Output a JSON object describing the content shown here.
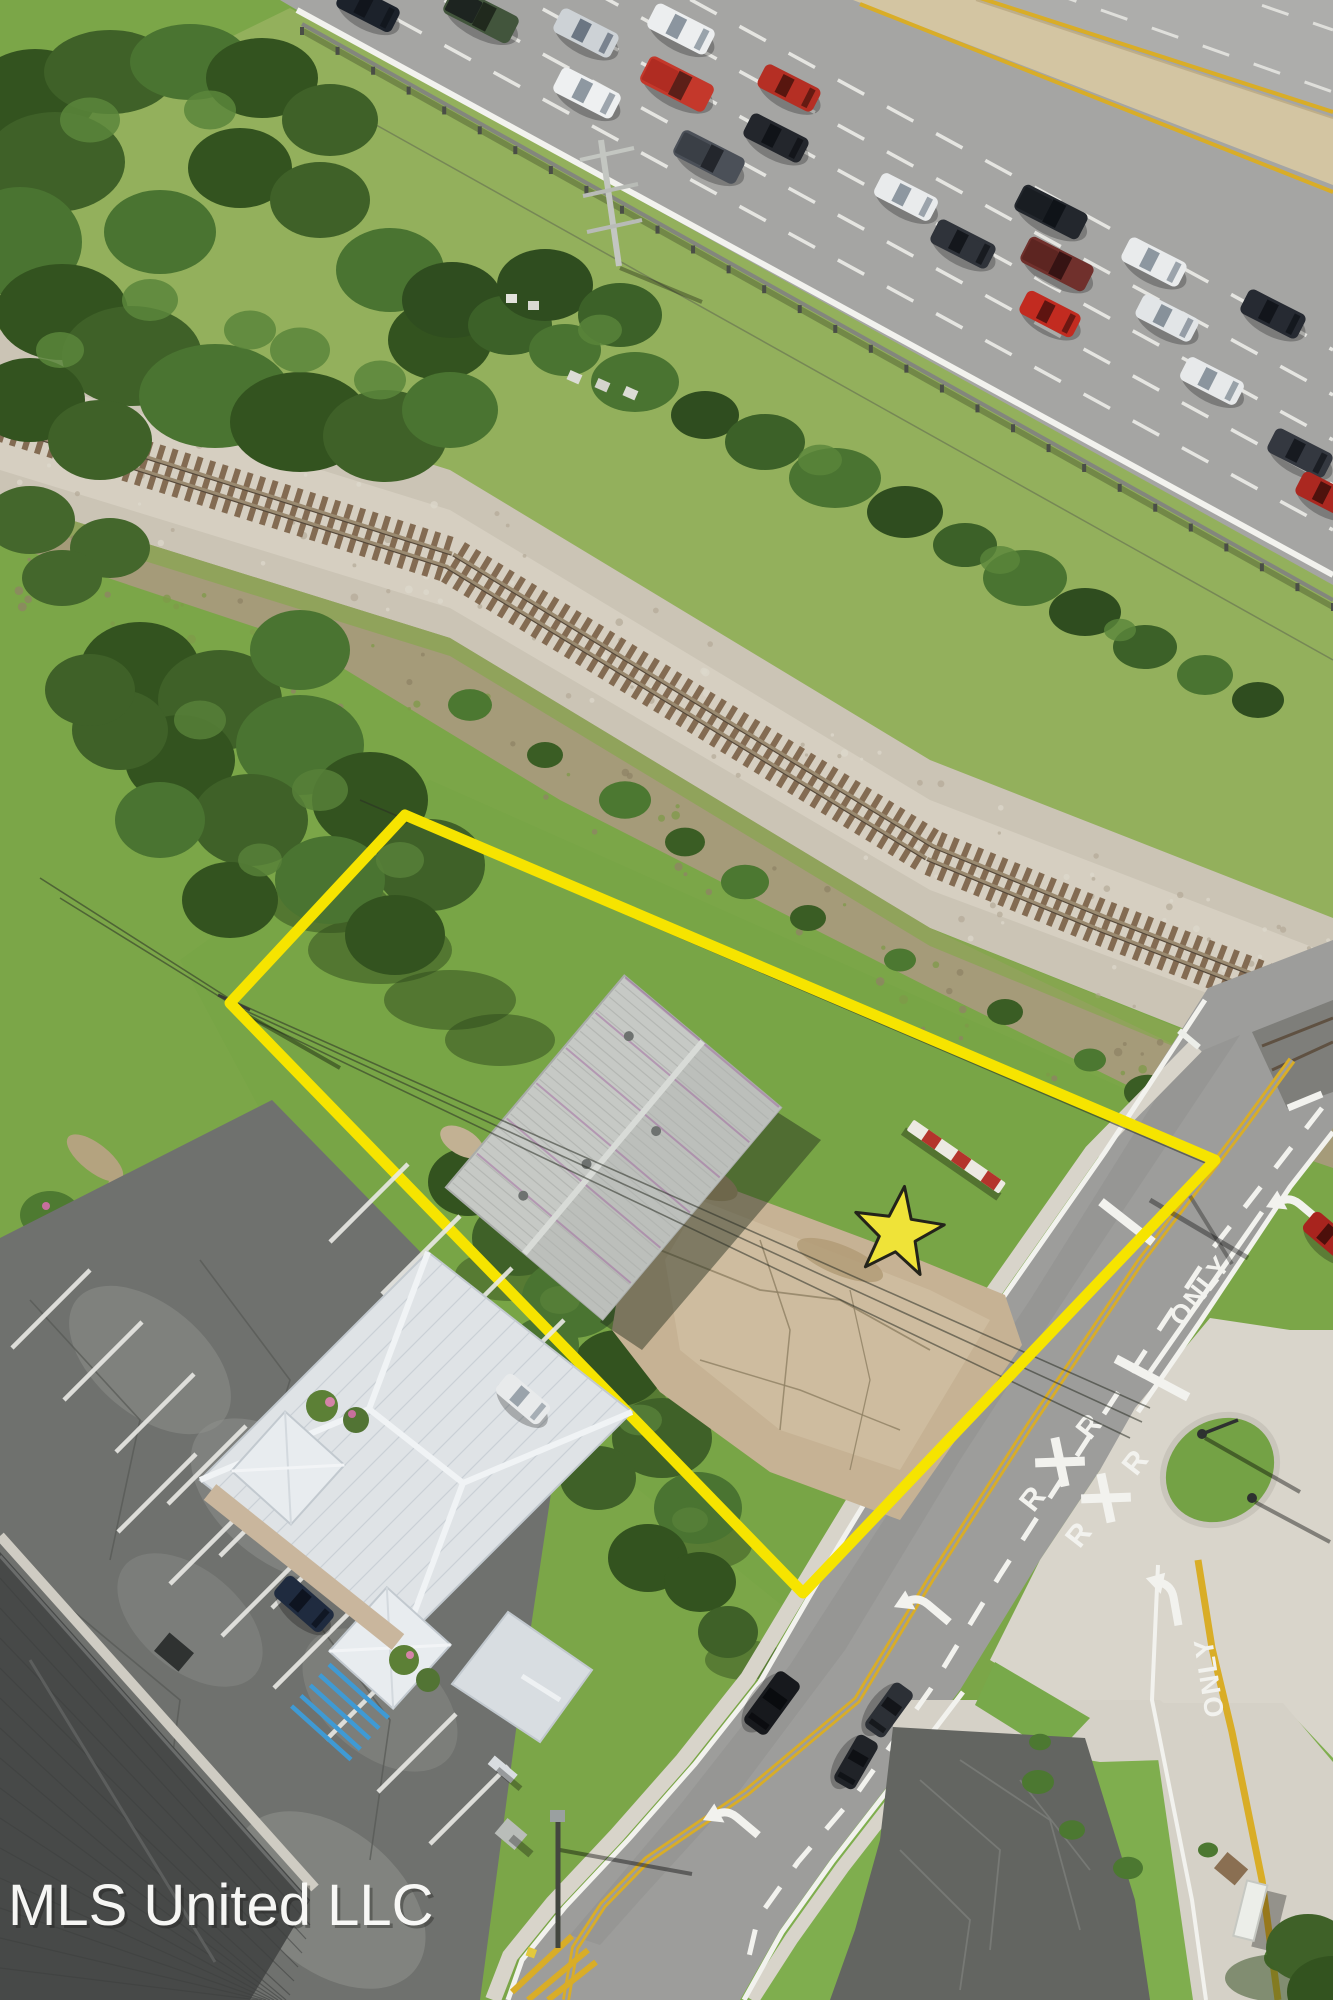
{
  "watermark": {
    "text": "MLS United LLC"
  },
  "property": {
    "boundary_points": "405,815 1215,1160 803,1593 230,1003",
    "boundary_color": "#f6e400",
    "star": {
      "cx": 898,
      "cy": 1233,
      "outer_r": 47,
      "inner_r": 19,
      "rotation": 8,
      "fill": "#efe338",
      "stroke": "#23231a"
    }
  },
  "road_markings": {
    "only_label": "ONLY",
    "rxr_letter": "R",
    "only_instances": [
      {
        "x": 1207,
        "y": 1296,
        "rot": -52
      },
      {
        "x": 1218,
        "y": 1676,
        "rot": -99
      }
    ],
    "rxr_instances": [
      {
        "x": 1060,
        "y": 1462,
        "rot": -52
      },
      {
        "x": 1106,
        "y": 1498,
        "rot": -52
      }
    ],
    "turn_arrows": [
      {
        "x": 1300,
        "y": 1207,
        "rot": -50
      },
      {
        "x": 1172,
        "y": 1600,
        "rot": -10
      },
      {
        "x": 928,
        "y": 1607,
        "rot": -50
      },
      {
        "x": 737,
        "y": 1820,
        "rot": -50
      }
    ],
    "stop_bars": [
      {
        "x": 1127,
        "y": 1222,
        "len": 66,
        "rot": 38
      },
      {
        "x": 1152,
        "y": 1378,
        "len": 82,
        "rot": 28
      }
    ]
  },
  "railroad": {
    "path": [
      [
        0,
        418
      ],
      [
        450,
        560
      ],
      [
        930,
        852
      ],
      [
        1100,
        922
      ],
      [
        1333,
        1012
      ]
    ]
  },
  "cars": {
    "highway": [
      {
        "x": 368,
        "y": 8,
        "rot": 27,
        "len": 62,
        "wid": 27,
        "body": "#1c222b",
        "glass": "#11151c"
      },
      {
        "x": 481,
        "y": 15,
        "rot": 27,
        "len": 74,
        "wid": 30,
        "body": "#42553c",
        "glass": "#20291d",
        "bed": "#1d2420"
      },
      {
        "x": 586,
        "y": 33,
        "rot": 27,
        "len": 64,
        "wid": 27,
        "body": "#cdd2d6",
        "glass": "#6b7683"
      },
      {
        "x": 681,
        "y": 29,
        "rot": 27,
        "len": 66,
        "wid": 28,
        "body": "#eceeef",
        "glass": "#8b959f"
      },
      {
        "x": 587,
        "y": 93,
        "rot": 27,
        "len": 66,
        "wid": 28,
        "body": "#eef0f1",
        "glass": "#8e98a1"
      },
      {
        "x": 677,
        "y": 84,
        "rot": 27,
        "len": 72,
        "wid": 30,
        "body": "#c4382b",
        "glass": "#5c1f18",
        "bed": "#b02c22"
      },
      {
        "x": 789,
        "y": 88,
        "rot": 27,
        "len": 62,
        "wid": 26,
        "body": "#b52f24",
        "glass": "#58160f"
      },
      {
        "x": 776,
        "y": 138,
        "rot": 27,
        "len": 64,
        "wid": 27,
        "body": "#23262c",
        "glass": "#101318"
      },
      {
        "x": 709,
        "y": 157,
        "rot": 27,
        "len": 70,
        "wid": 29,
        "body": "#4b5058",
        "glass": "#23262c",
        "bed": "#3a3f46"
      },
      {
        "x": 906,
        "y": 197,
        "rot": 27,
        "len": 63,
        "wid": 26,
        "body": "#e9ebec",
        "glass": "#8d97a0"
      },
      {
        "x": 963,
        "y": 244,
        "rot": 27,
        "len": 64,
        "wid": 27,
        "body": "#2f333a",
        "glass": "#14171c"
      },
      {
        "x": 1051,
        "y": 212,
        "rot": 27,
        "len": 72,
        "wid": 29,
        "body": "#23272d",
        "glass": "#0f1318",
        "bed": "#191d22"
      },
      {
        "x": 1057,
        "y": 264,
        "rot": 27,
        "len": 72,
        "wid": 29,
        "body": "#70302c",
        "glass": "#361313",
        "bed": "#5d2521"
      },
      {
        "x": 1050,
        "y": 314,
        "rot": 27,
        "len": 60,
        "wid": 26,
        "body": "#c22b20",
        "glass": "#5e1410"
      },
      {
        "x": 1154,
        "y": 262,
        "rot": 27,
        "len": 64,
        "wid": 27,
        "body": "#e9ebec",
        "glass": "#8d97a0"
      },
      {
        "x": 1167,
        "y": 318,
        "rot": 27,
        "len": 62,
        "wid": 26,
        "body": "#e2e5e7",
        "glass": "#87919a"
      },
      {
        "x": 1273,
        "y": 314,
        "rot": 27,
        "len": 64,
        "wid": 27,
        "body": "#262a32",
        "glass": "#12151b"
      },
      {
        "x": 1212,
        "y": 381,
        "rot": 27,
        "len": 63,
        "wid": 26,
        "body": "#e7e9ea",
        "glass": "#8b959e"
      },
      {
        "x": 1300,
        "y": 453,
        "rot": 27,
        "len": 64,
        "wid": 27,
        "body": "#343840",
        "glass": "#171a20"
      },
      {
        "x": 1326,
        "y": 495,
        "rot": 27,
        "len": 60,
        "wid": 26,
        "body": "#ab2820",
        "glass": "#4e120d"
      }
    ],
    "street": [
      {
        "x": 772,
        "y": 1703,
        "rot": 126,
        "len": 64,
        "wid": 28,
        "body": "#17191d",
        "glass": "#090b0e"
      },
      {
        "x": 889,
        "y": 1710,
        "rot": 126,
        "len": 56,
        "wid": 24,
        "body": "#2c3036",
        "glass": "#131519"
      },
      {
        "x": 856,
        "y": 1762,
        "rot": 120,
        "len": 54,
        "wid": 24,
        "body": "#202328",
        "glass": "#0e1014"
      },
      {
        "x": 1330,
        "y": 1237,
        "rot": 40,
        "len": 56,
        "wid": 25,
        "body": "#a8241e",
        "glass": "#4c0f0b"
      }
    ],
    "parked": [
      {
        "x": 304,
        "y": 1604,
        "rot": 41,
        "len": 62,
        "wid": 27,
        "body": "#1f2b3f",
        "glass": "#0e1420"
      },
      {
        "x": 523,
        "y": 1399,
        "rot": 40,
        "len": 56,
        "wid": 25,
        "body": "#e8eaeb",
        "glass": "#9aa3ab"
      }
    ]
  },
  "colors": {
    "grass": "#7ba648",
    "grass_shoulder": "#9cb863",
    "grass_lawn": "#7fae4e",
    "asphalt_road": "#9d9d9b",
    "asphalt_hwy": "#a5a5a3",
    "concrete": "#d9d5cb",
    "gravel": "#cbc4b5",
    "dirt": "#a89a7c",
    "median": "#d3c5a2",
    "double_yellow": "#d9ad27",
    "lane_white": "#f2f2ee",
    "roof_metal": "#c6c9c5",
    "roof_white": "#dfe3e6",
    "roof_dark": "#474948",
    "lot_asphalt": "#6f716e",
    "lot_old": "#636561",
    "pad_concrete": "#c6b294",
    "handicap_blue": "#3f9ad4",
    "tree_dark": "#3c6128",
    "tree_mid": "#4a7431",
    "tree_light": "#5a863b"
  }
}
